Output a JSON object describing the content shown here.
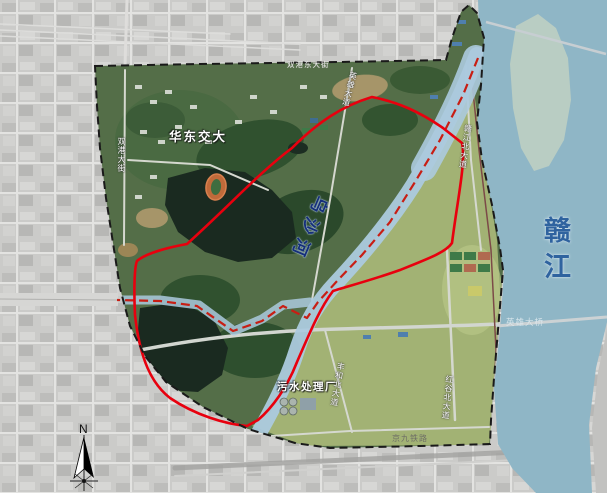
{
  "map": {
    "labels": {
      "university": "华东交大",
      "gan_river": "赣江",
      "wusha_river": "乌沙河",
      "sewage_plant": "污水处理厂",
      "hero_bridge": "英雄大桥",
      "jingjiu_railway": "京九铁路",
      "road_shuanggang_east": "双港东大街",
      "road_shuanggang": "双港大街",
      "road_yingxiong": "英雄大道",
      "road_ganjiang_north": "赣江北大道",
      "road_fenghe_north": "丰和北大道",
      "road_honggu_north": "红谷北大道"
    },
    "compass": {
      "north": "N"
    },
    "colors": {
      "planning_boundary": "#1a1a1a",
      "red_line": "#e8000e",
      "waterway_dash": "#c81e14",
      "gan_river": "#8fb6c6",
      "small_river": "#accade",
      "river_label_blue": "#2f639f",
      "wusha_label_blue": "#16307a"
    }
  }
}
